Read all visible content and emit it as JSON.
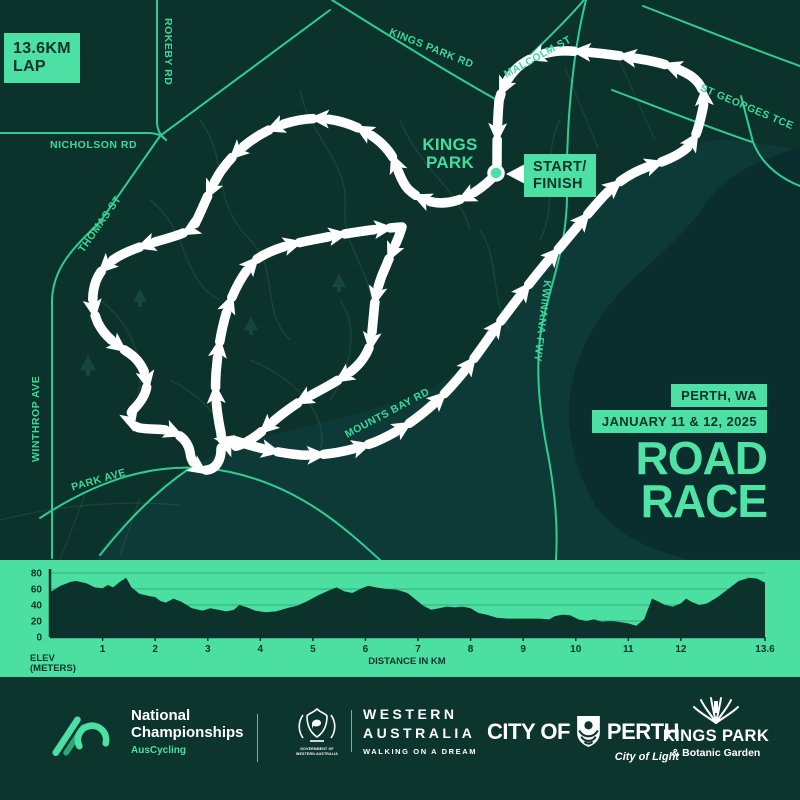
{
  "colors": {
    "bg": "#0b332c",
    "mint": "#4ce0a4",
    "mint_label": "#3ed89b",
    "road": "#2fcd92",
    "water": "#0d3a37",
    "water_deep": "#0a2e2d",
    "course": "#ffffff",
    "dark_text": "#0b332c"
  },
  "lap_badge": {
    "line1": "13.6KM",
    "line2": "LAP"
  },
  "map": {
    "roads": {
      "rokeby": "ROKEBY RD",
      "nicholson": "NICHOLSON RD",
      "thomas": "THOMAS ST",
      "winthrop": "WINTHROP AVE",
      "park_ave": "PARK AVE",
      "kings_park_rd": "KINGS PARK RD",
      "malcolm": "MALCOLM ST",
      "st_georges": "ST GEORGES TCE",
      "mounts_bay": "MOUNTS BAY RD",
      "kwinana": "KWINANA FWY"
    },
    "park_label_line1": "KINGS",
    "park_label_line2": "PARK",
    "start_finish_line1": "START/",
    "start_finish_line2": "FINISH"
  },
  "event": {
    "location": "PERTH, WA",
    "dates": "JANUARY 11 & 12, 2025",
    "title_line1": "ROAD",
    "title_line2": "RACE"
  },
  "chart_data": {
    "type": "area",
    "xlabel": "DISTANCE IN KM",
    "ylabel_line1": "ELEV",
    "ylabel_line2": "(METERS)",
    "xlim": [
      0,
      13.6
    ],
    "ylim": [
      0,
      80
    ],
    "yticks": [
      0,
      20,
      40,
      60,
      80
    ],
    "xticks": [
      1,
      2,
      3,
      4,
      5,
      6,
      7,
      8,
      9,
      10,
      11,
      12,
      13.6
    ],
    "xtick_labels": [
      "1",
      "2",
      "3",
      "4",
      "5",
      "6",
      "7",
      "8",
      "9",
      "10",
      "11",
      "12",
      "13.6"
    ],
    "profile_km": [
      0,
      0.2,
      0.4,
      0.5,
      0.7,
      0.85,
      1.0,
      1.1,
      1.2,
      1.35,
      1.45,
      1.55,
      1.7,
      1.9,
      2.0,
      2.1,
      2.2,
      2.35,
      2.5,
      2.7,
      2.9,
      3.05,
      3.2,
      3.35,
      3.5,
      3.6,
      3.75,
      3.9,
      4.1,
      4.3,
      4.5,
      4.7,
      4.9,
      5.1,
      5.3,
      5.45,
      5.6,
      5.75,
      5.9,
      6.05,
      6.2,
      6.4,
      6.6,
      6.8,
      6.95,
      7.1,
      7.25,
      7.4,
      7.55,
      7.7,
      7.85,
      8.0,
      8.15,
      8.3,
      8.5,
      8.7,
      9.0,
      9.3,
      9.5,
      9.6,
      9.75,
      9.9,
      10.05,
      10.2,
      10.35,
      10.5,
      10.65,
      10.8,
      11.0,
      11.15,
      11.3,
      11.45,
      11.55,
      11.7,
      11.85,
      12.0,
      12.1,
      12.2,
      12.35,
      12.5,
      12.7,
      12.9,
      13.1,
      13.3,
      13.45,
      13.6
    ],
    "profile_m": [
      56,
      64,
      69,
      70,
      67,
      62,
      61,
      65,
      62,
      70,
      74,
      62,
      54,
      51,
      50,
      45,
      43,
      48,
      44,
      36,
      33,
      36,
      34,
      32,
      34,
      40,
      37,
      33,
      31,
      32,
      36,
      39,
      45,
      52,
      58,
      62,
      57,
      55,
      60,
      64,
      62,
      60,
      59,
      55,
      47,
      39,
      34,
      36,
      38,
      37,
      38,
      36,
      30,
      28,
      24,
      23,
      23,
      23,
      22,
      26,
      28,
      27,
      22,
      20,
      22,
      19,
      20,
      19,
      17,
      14,
      22,
      48,
      45,
      40,
      38,
      42,
      48,
      44,
      40,
      42,
      50,
      60,
      70,
      74,
      73,
      68
    ]
  },
  "footer": {
    "auscycling": {
      "line1": "National",
      "line2": "Championships",
      "sub": "AusCycling"
    },
    "wa": {
      "crest_line1": "GOVERNMENT OF",
      "crest_line2": "WESTERN AUSTRALIA",
      "line1": "WESTERN",
      "line2": "AUSTRALIA",
      "tagline": "WALKING ON A DREAM"
    },
    "perth": {
      "prefix": "CITY OF",
      "name": "PERTH",
      "tagline": "City of Light"
    },
    "kings_park": {
      "line1": "KINGS PARK",
      "line2": "& Botanic Garden"
    }
  }
}
